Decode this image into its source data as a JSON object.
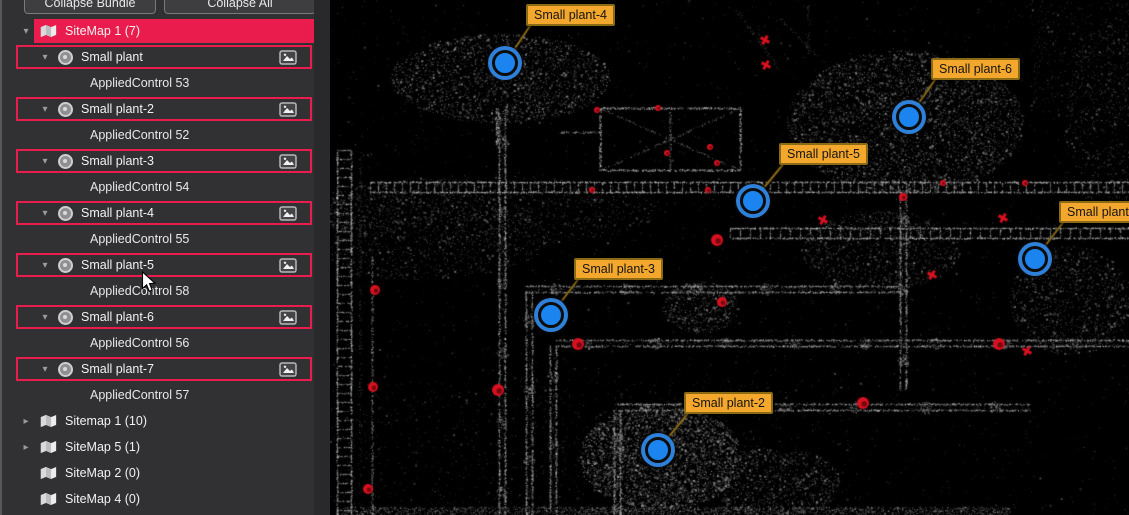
{
  "colors": {
    "accent": "#ea1b4d",
    "panel_bg": "#313134",
    "tag_bg": "#f4a72d",
    "tag_border": "#8a6a15",
    "leader": "#8a6a15",
    "marker_fill": "#1b84ee",
    "marker_ring": "#2f80d9",
    "target_red": "#d8101f"
  },
  "panel": {
    "collapse_bundle_button": "Collapse Bundle",
    "collapse_all_button": "Collapse All",
    "tree": [
      {
        "kind": "bundle",
        "label": "SiteMap 1 (7)",
        "selected": true,
        "caret": "expanded"
      },
      {
        "kind": "scan",
        "label": "Small plant",
        "caret": "expanded"
      },
      {
        "kind": "control",
        "label": "AppliedControl 53"
      },
      {
        "kind": "scan",
        "label": "Small plant-2",
        "caret": "expanded"
      },
      {
        "kind": "control",
        "label": "AppliedControl 52"
      },
      {
        "kind": "scan",
        "label": "Small plant-3",
        "caret": "expanded"
      },
      {
        "kind": "control",
        "label": "AppliedControl 54"
      },
      {
        "kind": "scan",
        "label": "Small plant-4",
        "caret": "expanded"
      },
      {
        "kind": "control",
        "label": "AppliedControl 55"
      },
      {
        "kind": "scan",
        "label": "Small plant-5",
        "caret": "expanded"
      },
      {
        "kind": "control",
        "label": "AppliedControl 58"
      },
      {
        "kind": "scan",
        "label": "Small plant-6",
        "caret": "expanded"
      },
      {
        "kind": "control",
        "label": "AppliedControl 56"
      },
      {
        "kind": "scan",
        "label": "Small plant-7",
        "caret": "expanded"
      },
      {
        "kind": "control",
        "label": "AppliedControl 57"
      },
      {
        "kind": "bundle",
        "label": "Sitemap 1 (10)",
        "caret": "collapsed"
      },
      {
        "kind": "bundle",
        "label": "SiteMap 5 (1)",
        "caret": "collapsed"
      },
      {
        "kind": "bundle",
        "label": "SiteMap 2 (0)",
        "caret": "none"
      },
      {
        "kind": "bundle",
        "label": "SiteMap 4 (0)",
        "caret": "none"
      }
    ]
  },
  "viewer": {
    "markers": [
      {
        "label": "Small plant-4",
        "x": 175,
        "y": 63,
        "tag_x": 196,
        "tag_y": 4
      },
      {
        "label": "Small plant-6",
        "x": 579,
        "y": 117,
        "tag_x": 601,
        "tag_y": 58
      },
      {
        "label": "Small plant-5",
        "x": 423,
        "y": 201,
        "tag_x": 449,
        "tag_y": 143
      },
      {
        "label": "Small plant-7",
        "x": 705,
        "y": 259,
        "tag_x": 729,
        "tag_y": 201
      },
      {
        "label": "Small plant-3",
        "x": 221,
        "y": 315,
        "tag_x": 244,
        "tag_y": 258
      },
      {
        "label": "Small plant-2",
        "x": 328,
        "y": 450,
        "tag_x": 354,
        "tag_y": 392
      }
    ],
    "targets": [
      {
        "x": 267,
        "y": 110,
        "r": 3,
        "shape": "dot"
      },
      {
        "x": 328,
        "y": 108,
        "r": 3,
        "shape": "dot"
      },
      {
        "x": 337,
        "y": 153,
        "r": 3,
        "shape": "dot"
      },
      {
        "x": 380,
        "y": 147,
        "r": 3,
        "shape": "dot"
      },
      {
        "x": 387,
        "y": 163,
        "r": 3,
        "shape": "dot"
      },
      {
        "x": 262,
        "y": 190,
        "r": 3,
        "shape": "dot"
      },
      {
        "x": 378,
        "y": 190,
        "r": 3,
        "shape": "dot"
      },
      {
        "x": 387,
        "y": 240,
        "r": 6,
        "shape": "dot"
      },
      {
        "x": 613,
        "y": 183,
        "r": 3,
        "shape": "dot"
      },
      {
        "x": 695,
        "y": 183,
        "r": 3,
        "shape": "dot"
      },
      {
        "x": 573,
        "y": 197,
        "r": 4,
        "shape": "dot"
      },
      {
        "x": 168,
        "y": 390,
        "r": 6,
        "shape": "dot"
      },
      {
        "x": 248,
        "y": 344,
        "r": 6,
        "shape": "dot"
      },
      {
        "x": 392,
        "y": 302,
        "r": 5,
        "shape": "dot"
      },
      {
        "x": 669,
        "y": 344,
        "r": 6,
        "shape": "dot"
      },
      {
        "x": 533,
        "y": 403,
        "r": 6,
        "shape": "dot"
      },
      {
        "x": 45,
        "y": 290,
        "r": 5,
        "shape": "dot"
      },
      {
        "x": 43,
        "y": 387,
        "r": 5,
        "shape": "dot"
      },
      {
        "x": 38,
        "y": 489,
        "r": 5,
        "shape": "dot"
      },
      {
        "x": 435,
        "y": 40,
        "r": 5,
        "shape": "cross"
      },
      {
        "x": 436,
        "y": 65,
        "r": 5,
        "shape": "cross"
      },
      {
        "x": 493,
        "y": 220,
        "r": 5,
        "shape": "cross"
      },
      {
        "x": 673,
        "y": 218,
        "r": 5,
        "shape": "cross"
      },
      {
        "x": 602,
        "y": 275,
        "r": 5,
        "shape": "cross"
      },
      {
        "x": 697,
        "y": 351,
        "r": 5,
        "shape": "cross"
      }
    ]
  },
  "cursor": {
    "x": 141,
    "y": 271
  }
}
